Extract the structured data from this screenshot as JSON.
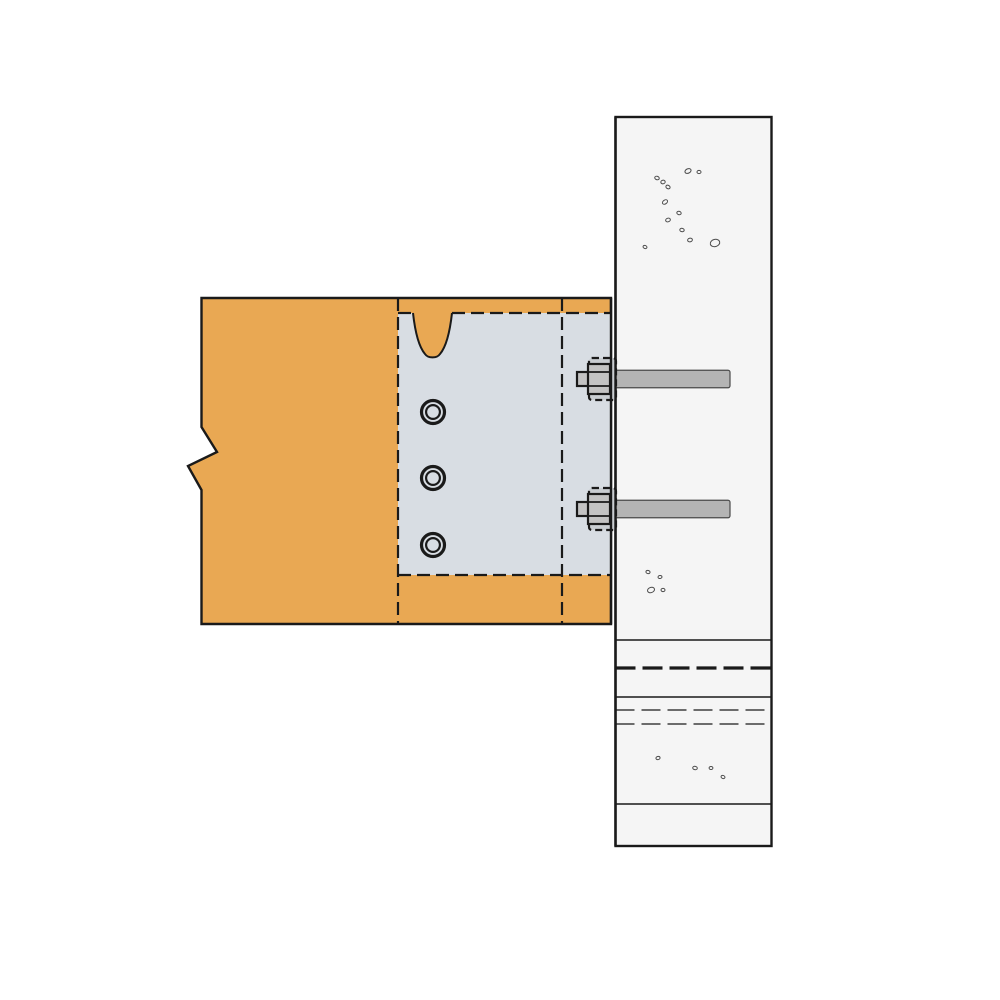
{
  "colors": {
    "background": "#ffffff",
    "outline": "#1a1a1a",
    "beam": "#e9a853",
    "hanger": "#d8dde3",
    "column": "#f5f5f5",
    "bolt_shaft": "#b4b4b4",
    "bolt_shaft_outline": "#4a4a4a",
    "nut": "#c3c3c3",
    "washer": "#c9cdd1",
    "speckle": "#4a4a4a"
  },
  "hanger": {
    "holes": [
      {
        "cx": 433,
        "cy": 412
      },
      {
        "cx": 433,
        "cy": 478
      },
      {
        "cx": 433,
        "cy": 545
      }
    ]
  },
  "bolts": {
    "centers_y": [
      379,
      509
    ]
  },
  "column": {
    "solid_lines_y": [
      640,
      697,
      804
    ],
    "heavy_dashed_y": [
      668
    ],
    "thin_dashed_y": [
      710,
      724
    ],
    "speckles": [
      {
        "cx": 688,
        "cy": 171,
        "rx": 3.2,
        "ry": 2.2,
        "rot": -25
      },
      {
        "cx": 699,
        "cy": 172,
        "rx": 2.0,
        "ry": 1.6,
        "rot": 0
      },
      {
        "cx": 657,
        "cy": 178,
        "rx": 2.3,
        "ry": 1.7,
        "rot": 20
      },
      {
        "cx": 663,
        "cy": 182,
        "rx": 2.2,
        "ry": 1.8,
        "rot": -10
      },
      {
        "cx": 668,
        "cy": 187,
        "rx": 2.2,
        "ry": 1.7,
        "rot": 30
      },
      {
        "cx": 665,
        "cy": 202,
        "rx": 2.8,
        "ry": 1.9,
        "rot": -35
      },
      {
        "cx": 679,
        "cy": 213,
        "rx": 2.2,
        "ry": 1.7,
        "rot": 15
      },
      {
        "cx": 668,
        "cy": 220,
        "rx": 2.4,
        "ry": 1.8,
        "rot": -20
      },
      {
        "cx": 682,
        "cy": 230,
        "rx": 2.2,
        "ry": 1.7,
        "rot": 10
      },
      {
        "cx": 690,
        "cy": 240,
        "rx": 2.4,
        "ry": 1.8,
        "rot": -15
      },
      {
        "cx": 645,
        "cy": 247,
        "rx": 2.0,
        "ry": 1.5,
        "rot": 20
      },
      {
        "cx": 715,
        "cy": 243,
        "rx": 4.8,
        "ry": 3.6,
        "rot": -15
      },
      {
        "cx": 648,
        "cy": 572,
        "rx": 2.1,
        "ry": 1.6,
        "rot": 15
      },
      {
        "cx": 660,
        "cy": 577,
        "rx": 2.0,
        "ry": 1.5,
        "rot": -10
      },
      {
        "cx": 651,
        "cy": 590,
        "rx": 3.6,
        "ry": 2.6,
        "rot": -20
      },
      {
        "cx": 663,
        "cy": 590,
        "rx": 2.0,
        "ry": 1.6,
        "rot": 10
      },
      {
        "cx": 658,
        "cy": 758,
        "rx": 2.1,
        "ry": 1.6,
        "rot": -15
      },
      {
        "cx": 695,
        "cy": 768,
        "rx": 2.3,
        "ry": 1.7,
        "rot": 10
      },
      {
        "cx": 711,
        "cy": 768,
        "rx": 1.9,
        "ry": 1.5,
        "rot": 0
      },
      {
        "cx": 723,
        "cy": 777,
        "rx": 2.0,
        "ry": 1.5,
        "rot": 20
      }
    ]
  }
}
